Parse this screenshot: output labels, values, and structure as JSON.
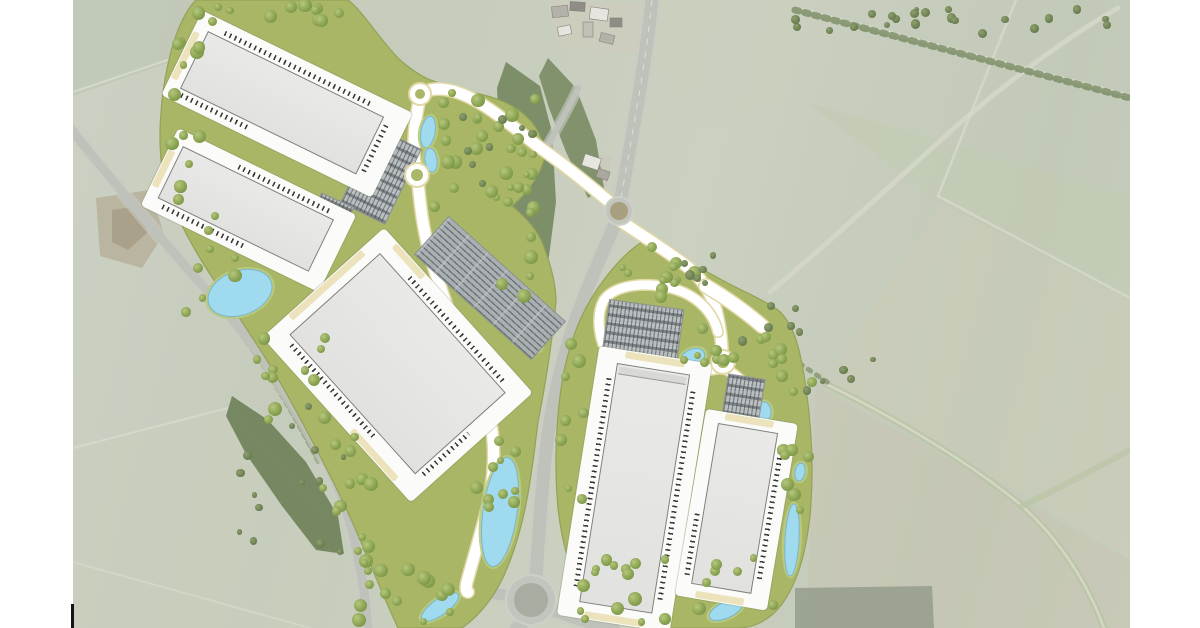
{
  "meta": {
    "description": "Aerial masterplan render of a two-parcel logistics park with five warehouse units, dock yards, car parks, attenuation ponds, tree buffers and new access roads set in farmland",
    "canvas": {
      "width": 1200,
      "height": 628,
      "content_left": 73,
      "content_right": 1130
    },
    "survey_tick": {
      "x": 71,
      "y": 604,
      "w": 3,
      "h": 24
    }
  },
  "colors": {
    "page": "#ffffff",
    "parcel_green": "#a8b666",
    "parcel_edge": "#93a258",
    "road_new": "#ffffff",
    "road_casing": "#e2d8a6",
    "road_old": "#bfc2bb",
    "road_old_verge": "#c9ccc4",
    "building_fill": "#e7e7e5",
    "building_edge": "#7e7e7a",
    "yard": "#fbfbf9",
    "pond_water": "#a0daef",
    "pond_bank": "#b9cb7e",
    "pond_edge": "#7ab6d1",
    "hedge": "#6e8156",
    "woodland": "#6d8156",
    "accent_beige": "#ece3bd",
    "dock_tick": "#3a3a38"
  },
  "scene": {
    "tone_polygons": [
      {
        "name": "field-top-left",
        "d": "M73,0 L348,0 L73,96 Z",
        "fill": "#b9c2b0",
        "op": 0.55
      },
      {
        "name": "field-north-of-road",
        "d": "M656,0 L795,0 L795,95 L706,128 L650,56 Z",
        "fill": "#c9cfbe",
        "op": 0.5
      },
      {
        "name": "field-green-northeast",
        "d": "M806,102 L1130,196 L1130,300 L940,202 Z",
        "fill": "#c2ccb2",
        "op": 0.6
      },
      {
        "name": "field-east",
        "d": "M940,202 L1130,300 L1130,556 L824,382 Z",
        "fill": "#cbcbb8",
        "op": 0.45
      },
      {
        "name": "field-southeast",
        "d": "M816,386 L1130,560 L1130,628 L806,628 Z",
        "fill": "#c7c4b2",
        "op": 0.5
      },
      {
        "name": "field-southwest",
        "d": "M73,452 L228,410 L334,524 L312,628 L73,628 Z",
        "fill": "#c9cdbc",
        "op": 0.55
      },
      {
        "name": "disturbed-ground",
        "d": "M96,198 L150,190 L164,234 L142,268 L100,256 Z",
        "fill": "#b7b09b",
        "op": 0.85
      },
      {
        "name": "disturbed-ground-core",
        "d": "M112,210 L140,206 L148,232 L128,250 L112,242 Z",
        "fill": "#a89e88",
        "op": 0.9
      },
      {
        "name": "farm-yard",
        "d": "M546,0 L640,4 L636,52 L560,48 Z",
        "fill": "#cfccbf",
        "op": 0.65
      },
      {
        "name": "farm-yard-south",
        "d": "M578,150 L612,158 L606,188 L576,180 Z",
        "fill": "#ccc9bc",
        "op": 0.7
      },
      {
        "name": "woodland-block-southeast",
        "d": "M795,588 L932,586 L934,628 L795,628 Z",
        "fill": "#949c8c",
        "op": 0.85
      }
    ],
    "field_lines": [
      {
        "name": "boundary",
        "d": "M73,92 L345,0",
        "w": 2,
        "c": "#dadcce",
        "op": 0.8
      },
      {
        "name": "boundary",
        "d": "M1016,0 L938,196",
        "w": 2.5,
        "c": "#dadcce",
        "op": 0.7
      },
      {
        "name": "boundary",
        "d": "M938,196 L1130,298",
        "w": 2.5,
        "c": "#dadcce",
        "op": 0.7
      },
      {
        "name": "boundary",
        "d": "M73,448 L228,408 L332,522",
        "w": 2,
        "c": "#dadcce",
        "op": 0.7
      },
      {
        "name": "boundary",
        "d": "M73,562 L310,628",
        "w": 2,
        "c": "#dadcce",
        "op": 0.6
      },
      {
        "name": "green-lane",
        "d": "M826,384 C900,420 980,470 1022,506 C1060,540 1088,584 1104,628",
        "w": 7,
        "c": "#b9c4a4",
        "op": 0.8
      },
      {
        "name": "green-lane-center",
        "d": "M826,384 C900,420 980,470 1022,506 C1060,540 1088,584 1104,628",
        "w": 2.5,
        "c": "#d6d8c8",
        "op": 0.9
      },
      {
        "name": "green-lane-branch",
        "d": "M1022,506 C1060,488 1096,468 1130,450",
        "w": 6,
        "c": "#b9c4a4",
        "op": 0.7
      },
      {
        "name": "track-northeast",
        "d": "M770,292 C832,240 892,184 952,130 C1002,86 1062,40 1118,8",
        "w": 5,
        "c": "#d5d7c9",
        "op": 0.85
      },
      {
        "name": "hedgerow-road-top",
        "d": "M795,8 L1130,96",
        "w": 4,
        "c": "#d8dacb",
        "op": 0.9
      }
    ],
    "hedges": [
      {
        "name": "hedgerow",
        "d": "M795,10 L1130,98",
        "w": 7,
        "c": "#6e8156",
        "op": 0.7,
        "dash": "4 6"
      },
      {
        "name": "hedgerow",
        "d": "M642,258 L830,384",
        "w": 5,
        "c": "#6f8257",
        "op": 0.6,
        "dash": "3 7"
      },
      {
        "name": "hedgerow",
        "d": "M220,306 C258,352 292,408 320,464",
        "w": 6,
        "c": "#74875a",
        "op": 0.5,
        "dash": "4 5"
      },
      {
        "name": "hedgerow",
        "d": "M438,120 C470,150 502,170 535,185",
        "w": 4,
        "c": "#7a8c60",
        "op": 0.55,
        "dash": "3 5"
      }
    ],
    "woodland": [
      {
        "name": "woodland-southwest",
        "d": "M232,396 L268,420 L306,462 L338,516 L344,554 L316,550 L282,506 L246,454 L226,416 Z",
        "fill": "#6d8156",
        "op": 0.9
      },
      {
        "name": "woodland-east-of-parcel",
        "d": "M506,62 L540,86 L552,132 L556,202 L548,264 L530,302 L512,268 L504,200 L499,130 L497,88 Z",
        "fill": "#70845a",
        "op": 0.85
      },
      {
        "name": "woodland-by-farm",
        "d": "M548,58 L576,88 L596,140 L604,188 L588,198 L566,152 L549,108 L539,76 Z",
        "fill": "#6f8359",
        "op": 0.8
      }
    ],
    "old_roads": [
      {
        "name": "main-road-north",
        "d": "M652,0 C648,42 641,84 634,124 C628,160 623,186 620,204",
        "w": 13
      },
      {
        "name": "main-road-south",
        "d": "M614,226 C599,262 581,300 569,340 C557,380 549,420 545,460 C541,500 538,544 536,578",
        "w": 13
      },
      {
        "name": "roundabout-arm-south",
        "d": "M524,622 L516,628",
        "w": 12
      },
      {
        "name": "roundabout-arm-east",
        "d": "M552,610 C578,620 598,625 614,628",
        "w": 12
      },
      {
        "name": "roundabout-arm-west",
        "d": "M510,596 C494,593 480,592 468,592",
        "w": 11
      },
      {
        "name": "secondary-road-west",
        "d": "M70,128 C120,190 168,248 214,298 C260,348 299,408 329,468 C349,506 362,562 368,628",
        "w": 9
      },
      {
        "name": "farm-lane",
        "d": "M545,150 C556,130 568,110 578,88",
        "w": 6
      }
    ],
    "farm_buildings": [
      {
        "x": 552,
        "y": 6,
        "w": 16,
        "h": 11,
        "rot": -6,
        "fill": "#b3b1a8"
      },
      {
        "x": 570,
        "y": 2,
        "w": 15,
        "h": 9,
        "rot": 4,
        "fill": "#8f8d85"
      },
      {
        "x": 590,
        "y": 8,
        "w": 18,
        "h": 12,
        "rot": 8,
        "fill": "#e6e5df"
      },
      {
        "x": 610,
        "y": 18,
        "w": 12,
        "h": 9,
        "rot": 0,
        "fill": "#8f8d85"
      },
      {
        "x": 583,
        "y": 22,
        "w": 10,
        "h": 15,
        "rot": 0,
        "fill": "#c2c0b7"
      },
      {
        "x": 558,
        "y": 26,
        "w": 13,
        "h": 9,
        "rot": -12,
        "fill": "#e6e5df"
      },
      {
        "x": 600,
        "y": 34,
        "w": 14,
        "h": 9,
        "rot": 14,
        "fill": "#b3b1a8"
      },
      {
        "x": 583,
        "y": 156,
        "w": 17,
        "h": 12,
        "rot": 18,
        "fill": "#e6e5df"
      },
      {
        "x": 597,
        "y": 170,
        "w": 12,
        "h": 9,
        "rot": 18,
        "fill": "#a9a79e"
      }
    ],
    "parcels": [
      {
        "name": "parcel-west",
        "d": "M196,0 L348,0 C362,10 380,40 400,60 C414,72 424,78 436,82 L470,92 C492,96 520,104 536,128 C544,142 546,152 544,160 C538,180 524,196 512,206 C524,216 536,228 542,242 C550,262 556,282 556,302 C552,342 546,382 538,422 C532,472 526,522 508,566 C498,592 482,614 462,628 L398,628 C384,598 372,568 360,540 C340,492 314,444 290,400 C264,352 232,308 206,268 C186,236 168,202 162,168 C158,140 160,100 168,64 C174,36 184,12 196,0 Z"
      },
      {
        "name": "parcel-east",
        "d": "M642,242 C666,252 694,264 722,280 C744,292 764,300 778,310 C792,322 800,344 806,388 C812,430 814,472 810,516 C806,552 798,582 782,604 C770,620 754,628 738,628 L640,628 C618,620 598,610 584,592 C570,572 562,544 558,508 C554,466 556,420 562,382 C568,346 580,314 598,288 C612,268 626,252 642,242 Z"
      }
    ],
    "new_roads": [
      {
        "name": "site-access-west",
        "d": "M612,204 C590,186 566,166 546,152 C520,134 488,102 456,92 C444,88 432,88 425,92",
        "w": 11
      },
      {
        "name": "spine-north",
        "d": "M420,98 C414,122 412,150 416,170",
        "w": 11
      },
      {
        "name": "spine-south",
        "d": "M418,180 C420,208 424,235 432,262 C443,296 452,320 462,346 C472,372 484,396 490,420 C496,446 494,478 488,505 C482,530 474,556 468,578 C465,588 466,592 468,592",
        "w": 11
      },
      {
        "name": "site-access-east",
        "d": "M622,222 C640,234 662,248 684,264 C700,276 710,290 716,310 C720,326 722,342 722,354",
        "w": 11
      },
      {
        "name": "access-east-flare",
        "d": "M706,286 C726,298 746,312 762,326",
        "w": 13
      },
      {
        "name": "east-loop-north",
        "d": "M718,332 C712,308 692,292 666,287 C640,282 614,286 604,300 C597,312 598,330 603,344",
        "w": 9
      },
      {
        "name": "east-loop-south",
        "d": "M722,368 C702,372 680,373 660,370 C650,368 642,364 637,358",
        "w": 9
      },
      {
        "name": "east-stub",
        "d": "M727,370 C738,376 746,384 750,393",
        "w": 9
      }
    ],
    "ponds": [
      {
        "name": "pond",
        "cx": 240,
        "cy": 293,
        "rx": 33,
        "ry": 22,
        "rot": -20
      },
      {
        "name": "pond",
        "cx": 428,
        "cy": 132,
        "rx": 7,
        "ry": 16,
        "rot": 10
      },
      {
        "name": "pond",
        "cx": 431,
        "cy": 160,
        "rx": 6,
        "ry": 12,
        "rot": -8
      },
      {
        "name": "pond",
        "cx": 477,
        "cy": 256,
        "rx": 36,
        "ry": 8,
        "rot": 42
      },
      {
        "name": "pond",
        "cx": 523,
        "cy": 330,
        "rx": 26,
        "ry": 9,
        "rot": 50
      },
      {
        "name": "pond",
        "cx": 500,
        "cy": 512,
        "rx": 17,
        "ry": 55,
        "rot": 8
      },
      {
        "name": "pond",
        "cx": 440,
        "cy": 607,
        "rx": 22,
        "ry": 8,
        "rot": -35
      },
      {
        "name": "pond",
        "cx": 693,
        "cy": 357,
        "rx": 12,
        "ry": 8,
        "rot": -20
      },
      {
        "name": "pond",
        "cx": 764,
        "cy": 412,
        "rx": 7,
        "ry": 10,
        "rot": 0
      },
      {
        "name": "pond",
        "cx": 792,
        "cy": 540,
        "rx": 7,
        "ry": 36,
        "rot": 3
      },
      {
        "name": "pond",
        "cx": 726,
        "cy": 610,
        "rx": 18,
        "ry": 8,
        "rot": -25
      },
      {
        "name": "pond",
        "cx": 800,
        "cy": 472,
        "rx": 5,
        "ry": 9,
        "rot": 10
      }
    ],
    "buildings": [
      {
        "id": "unit-1",
        "x": 208,
        "y": 31,
        "w": 196,
        "h": 64,
        "rot": 26,
        "pads": {
          "t": 16,
          "r": 24,
          "b": 14,
          "l": 14
        },
        "docks": [
          {
            "s": "n",
            "f": 0.08,
            "t": 0.92
          },
          {
            "s": "e",
            "f": 0.1,
            "t": 0.9
          },
          {
            "s": "s",
            "f": 0.02,
            "t": 0.4
          }
        ],
        "accents": [
          {
            "s": "w",
            "f": 0.1,
            "t": 0.9
          }
        ],
        "bands": []
      },
      {
        "id": "unit-2",
        "x": 183,
        "y": 146,
        "w": 168,
        "h": 58,
        "rot": 26,
        "pads": {
          "t": 14,
          "r": 18,
          "b": 14,
          "l": 12
        },
        "docks": [
          {
            "s": "n",
            "f": 0.35,
            "t": 0.95
          },
          {
            "s": "s",
            "f": 0.05,
            "t": 0.6
          }
        ],
        "accents": [
          {
            "s": "w",
            "f": 0.15,
            "t": 0.85
          }
        ],
        "bands": []
      },
      {
        "id": "unit-3",
        "x": 380,
        "y": 253,
        "w": 188,
        "h": 122,
        "rot": 48,
        "pads": {
          "t": 20,
          "r": 18,
          "b": 22,
          "l": 16
        },
        "docks": [
          {
            "s": "n",
            "f": 0.2,
            "t": 0.96
          },
          {
            "s": "s",
            "f": 0.05,
            "t": 0.72
          },
          {
            "s": "e",
            "f": 0.45,
            "t": 0.95
          }
        ],
        "accents": [
          {
            "s": "n",
            "f": 0.02,
            "t": 0.25
          },
          {
            "s": "s",
            "f": 0.6,
            "t": 0.95
          },
          {
            "s": "w",
            "f": 0.1,
            "t": 0.9
          }
        ],
        "bands": []
      },
      {
        "id": "unit-4",
        "x": 617,
        "y": 363,
        "w": 74,
        "h": 242,
        "rot": 9,
        "pads": {
          "t": 14,
          "r": 20,
          "b": 16,
          "l": 20
        },
        "docks": [
          {
            "s": "w",
            "f": 0.06,
            "t": 0.94
          },
          {
            "s": "e",
            "f": 0.06,
            "t": 0.94
          }
        ],
        "accents": [
          {
            "s": "n",
            "f": 0.1,
            "t": 0.9
          },
          {
            "s": "s",
            "f": 0.1,
            "t": 0.9
          }
        ],
        "bands": [
          "n"
        ]
      },
      {
        "id": "unit-5",
        "x": 718,
        "y": 423,
        "w": 61,
        "h": 163,
        "rot": 9.5,
        "pads": {
          "t": 12,
          "r": 18,
          "b": 14,
          "l": 14
        },
        "docks": [
          {
            "s": "e",
            "f": 0.08,
            "t": 0.9
          },
          {
            "s": "w",
            "f": 0.55,
            "t": 0.95
          }
        ],
        "accents": [
          {
            "s": "n",
            "f": 0.1,
            "t": 0.9
          },
          {
            "s": "s",
            "f": 0.1,
            "t": 0.9
          }
        ],
        "bands": []
      }
    ],
    "parkings": [
      {
        "name": "car-park-main",
        "cx": 490,
        "cy": 288,
        "w": 158,
        "h": 52,
        "rot": 42,
        "style": "lot-lines"
      },
      {
        "name": "car-park-units12",
        "cx": 381,
        "cy": 176,
        "w": 50,
        "h": 84,
        "rot": 26,
        "style": "lot-rows"
      },
      {
        "name": "car-park-unit2-south",
        "cx": 320,
        "cy": 240,
        "w": 36,
        "h": 88,
        "rot": 24,
        "style": "lot-rows"
      },
      {
        "name": "car-park-east-parcel",
        "cx": 643,
        "cy": 331,
        "w": 76,
        "h": 54,
        "rot": 8,
        "style": "lot-rows"
      },
      {
        "name": "car-park-unit5",
        "cx": 743,
        "cy": 401,
        "w": 38,
        "h": 50,
        "rot": 9,
        "style": "lot-rows"
      }
    ],
    "new_roundabouts": [
      {
        "name": "roundabout-site-north",
        "cx": 420,
        "cy": 94,
        "r": 10
      },
      {
        "name": "roundabout-site-west",
        "cx": 417,
        "cy": 175,
        "r": 11
      },
      {
        "name": "roundabout-site-east",
        "cx": 723,
        "cy": 362,
        "r": 11
      }
    ],
    "old_roundabouts": [
      {
        "name": "roundabout-existing-mid",
        "cx": 619,
        "cy": 211,
        "r": 13
      },
      {
        "name": "roundabout-existing-south",
        "cx": 531,
        "cy": 600,
        "r": 24
      }
    ],
    "tree_zones": [
      {
        "x": 196,
        "y": 2,
        "w": 148,
        "h": 26,
        "n": 12,
        "pal": "p"
      },
      {
        "x": 432,
        "y": 86,
        "w": 106,
        "h": 124,
        "n": 30,
        "pal": "p"
      },
      {
        "x": 158,
        "y": 34,
        "w": 42,
        "h": 86,
        "n": 6,
        "pal": "p"
      },
      {
        "x": 170,
        "y": 120,
        "w": 34,
        "h": 96,
        "n": 6,
        "pal": "p"
      },
      {
        "x": 186,
        "y": 210,
        "w": 54,
        "h": 110,
        "n": 8,
        "pal": "p"
      },
      {
        "x": 248,
        "y": 332,
        "w": 82,
        "h": 96,
        "n": 12,
        "pal": "p"
      },
      {
        "x": 322,
        "y": 432,
        "w": 66,
        "h": 122,
        "n": 12,
        "pal": "p"
      },
      {
        "x": 356,
        "y": 556,
        "w": 132,
        "h": 68,
        "n": 16,
        "pal": "p"
      },
      {
        "x": 502,
        "y": 206,
        "w": 46,
        "h": 116,
        "n": 7,
        "pal": "p"
      },
      {
        "x": 476,
        "y": 438,
        "w": 44,
        "h": 104,
        "n": 10,
        "pal": "p"
      },
      {
        "x": 612,
        "y": 246,
        "w": 92,
        "h": 54,
        "n": 13,
        "pal": "p"
      },
      {
        "x": 676,
        "y": 326,
        "w": 62,
        "h": 40,
        "n": 8,
        "pal": "p"
      },
      {
        "x": 732,
        "y": 330,
        "w": 52,
        "h": 34,
        "n": 6,
        "pal": "p"
      },
      {
        "x": 780,
        "y": 358,
        "w": 32,
        "h": 152,
        "n": 10,
        "pal": "p"
      },
      {
        "x": 558,
        "y": 330,
        "w": 26,
        "h": 200,
        "n": 8,
        "pal": "p"
      },
      {
        "x": 578,
        "y": 558,
        "w": 204,
        "h": 66,
        "n": 22,
        "pal": "p"
      },
      {
        "x": 795,
        "y": 4,
        "w": 335,
        "h": 30,
        "n": 22,
        "pal": "a"
      },
      {
        "x": 640,
        "y": 248,
        "w": 84,
        "h": 38,
        "n": 6,
        "pal": "a"
      },
      {
        "x": 722,
        "y": 300,
        "w": 82,
        "h": 42,
        "n": 6,
        "pal": "a"
      },
      {
        "x": 802,
        "y": 356,
        "w": 72,
        "h": 42,
        "n": 5,
        "pal": "a"
      },
      {
        "x": 446,
        "y": 112,
        "w": 96,
        "h": 72,
        "n": 8,
        "pal": "a"
      },
      {
        "x": 230,
        "y": 396,
        "w": 116,
        "h": 158,
        "n": 14,
        "pal": "a"
      }
    ]
  }
}
